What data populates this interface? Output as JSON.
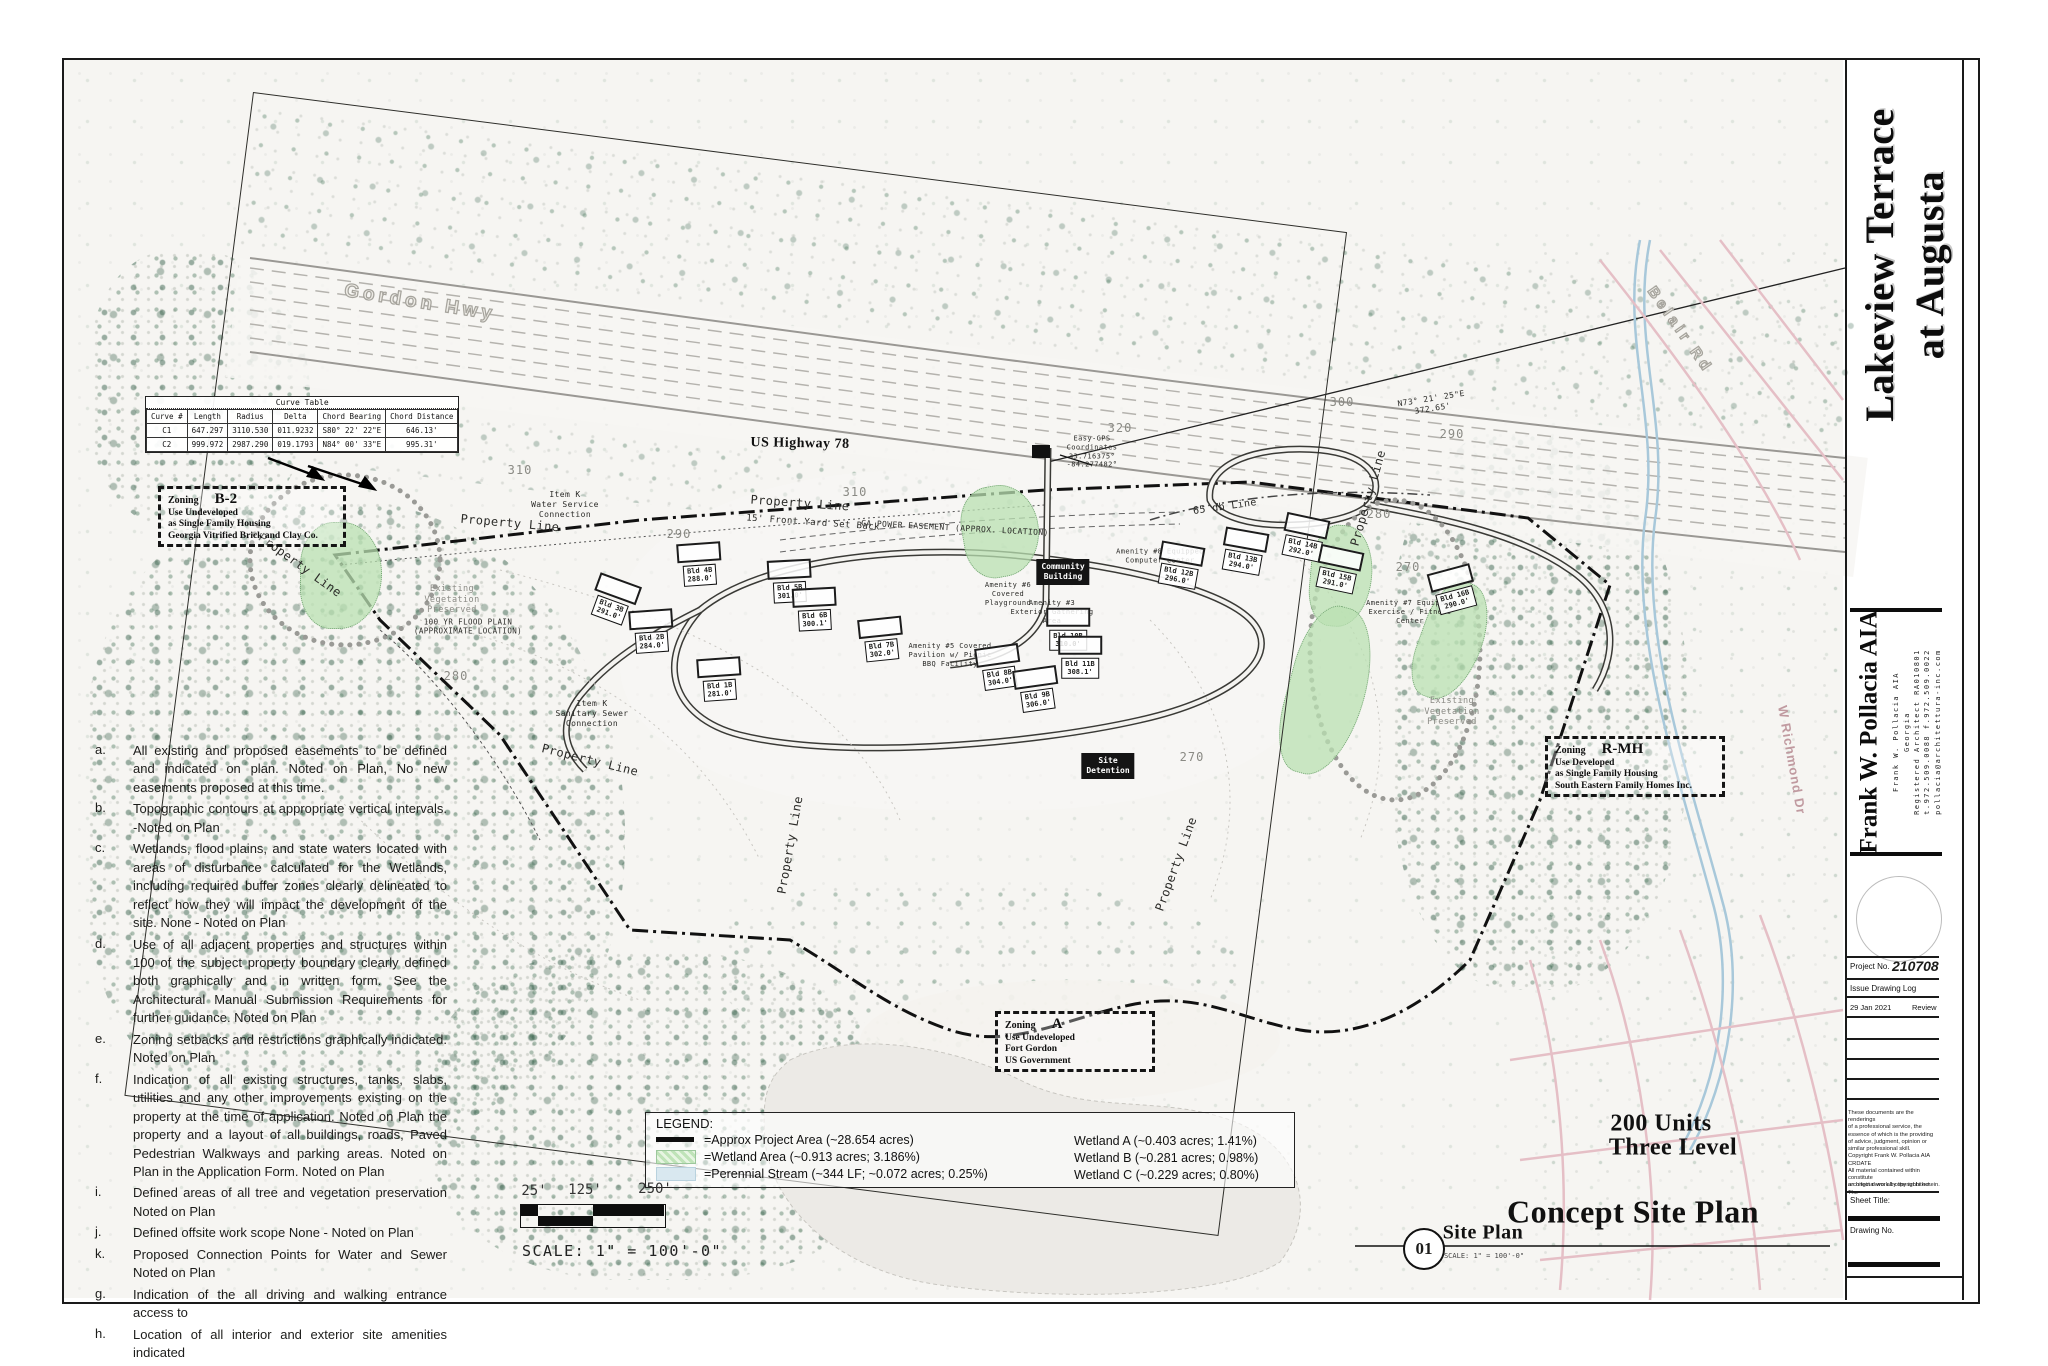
{
  "page": {
    "project_title": "Lakeview Terrace\nat Augusta",
    "drawing_title": "Concept Site Plan",
    "units_line1": "200 Units",
    "units_line2": "Three Level",
    "detail_number": "01",
    "detail_name": "Site Plan",
    "detail_scale": "SCALE: 1\" = 100'-0\"",
    "scale_text": "SCALE: 1\" = 100'-0\"",
    "scale_ticks": [
      "25'",
      "125'",
      "250'"
    ]
  },
  "architect": {
    "name_large": "Frank W. Pollacia AIA",
    "lines": [
      {
        "t": "Frank W. Pollacia AIA",
        "x": 1890
      },
      {
        "t": "Georgia",
        "x": 1901
      },
      {
        "t": "Registered Architect RA010801",
        "x": 1911
      },
      {
        "t": "t.972.509.0088 f.972.509.0022",
        "x": 1921
      },
      {
        "t": "pollacia@architettura-inc.com",
        "x": 1932
      }
    ]
  },
  "titleblock": {
    "project_no_label": "Project No.",
    "project_no": "210708",
    "issue_log_label": "Issue Drawing Log",
    "issue_date": "29 Jan 2021",
    "issue_desc": "Review",
    "disclaimer_lines": [
      {
        "t": "These documents are the renderings"
      },
      {
        "t": "of a professional service, the"
      },
      {
        "t": "essence of which is the providing"
      },
      {
        "t": "of advice, judgment, opinion or"
      },
      {
        "t": "similar professional skill."
      },
      {
        "t": "Copyright Frank W. Pollacia AIA CRDATE"
      },
      {
        "t": "All material contained within constitute"
      },
      {
        "t": "an original work by the architect. The"
      }
    ],
    "copyright_line": "architect owns all copyrights herein.",
    "sheet_title_label": "Sheet Title:",
    "drawing_no_label": "Drawing No."
  },
  "notes": [
    {
      "k": "a.",
      "t": "All existing and proposed easements to be defined and indicated on plan.  Noted on Plan, No new easements proposed at this time."
    },
    {
      "k": "b.",
      "t": "Topographic contours at appropriate vertical intervals. -Noted on Plan"
    },
    {
      "k": "c.",
      "t": "Wetlands, flood plains, and state waters located with areas of disturbance calculated for the Wetlands, including required buffer zones clearly delineated to reflect how they will impact the development of the site.  None - Noted on Plan"
    },
    {
      "k": "d.",
      "t": "Use of all adjacent properties and structures within 100 of the subject property  boundary clearly defined both graphically and in written form.  See the Architectural Manual Submission Requirements for further guidance.  Noted on Plan"
    },
    {
      "k": "e.",
      "t": "Zoning setbacks and restrictions graphically indicated. Noted on Plan"
    },
    {
      "k": "f.",
      "t": "Indication of all existing structures, tanks, slabs, utilities and any other improvements existing on the property at the time of application.  Noted on Plan the property and a layout of all buildings, roads, Paved Pedestrian Walkways and parking areas.  Noted on Plan in the Application Form.  Noted on Plan"
    },
    {
      "k": "i.",
      "t": "Defined areas of all tree and vegetation preservation Noted on Plan"
    },
    {
      "k": "j.",
      "t": "Defined offsite work scope None - Noted on Plan"
    },
    {
      "k": "k.",
      "t": "Proposed Connection Points for Water and Sewer Noted on Plan"
    },
    {
      "k": "g.",
      "t": "Indication of the all driving and walking entrance access to"
    },
    {
      "k": "h.",
      "t": "Location of all interior and exterior site amenities indicated"
    }
  ],
  "legend": {
    "title": "LEGEND:",
    "items": [
      {
        "label": "=Approx Project Area (~28.654 acres)"
      },
      {
        "label": "=Wetland Area (~0.913 acres; 3.186%)"
      },
      {
        "label": "=Perennial Stream (~344 LF; ~0.072 acres; 0.25%)"
      }
    ],
    "wetlands": [
      {
        "t": "Wetland A (~0.403 acres; 1.41%)"
      },
      {
        "t": "Wetland B (~0.281 acres; 0.98%)"
      },
      {
        "t": "Wetland C (~0.229 acres; 0.80%)"
      }
    ]
  },
  "curve_table": {
    "title": "Curve Table",
    "headers": [
      {
        "t": "Curve #"
      },
      {
        "t": "Length"
      },
      {
        "t": "Radius"
      },
      {
        "t": "Delta"
      },
      {
        "t": "Chord Bearing"
      },
      {
        "t": "Chord Distance"
      }
    ],
    "rows": [
      {
        "c0": "C1",
        "c1": "647.297",
        "c2": "3110.530",
        "c3": "011.9232",
        "c4": "S80° 22' 22\"E",
        "c5": "646.13'"
      },
      {
        "c0": "C2",
        "c1": "999.972",
        "c2": "2987.290",
        "c3": "019.1793",
        "c4": "N84° 00' 33\"E",
        "c5": "995.31'"
      }
    ]
  },
  "zoning": [
    {
      "title": "Zoning",
      "code": "B-2",
      "l1": "Use Undeveloped",
      "l2": "as Single Family Housing",
      "l3": "Georgia Vitrified Brick and Clay Co."
    },
    {
      "title": "Zoning",
      "code": "R-MH",
      "l1": "Use Developed",
      "l2": "as Single Family Housing",
      "l3": "South Eastern Family Homes Inc."
    },
    {
      "title": "Zoning",
      "code": "A",
      "l1": "Use Undeveloped",
      "l2": "Fort Gordon",
      "l3": "US Government"
    }
  ],
  "map": {
    "texts": [
      {
        "t": "Gordon Hwy",
        "x": 420,
        "y": 303,
        "rot": 9,
        "s": 19,
        "c": "outline"
      },
      {
        "t": "Belair Rd",
        "x": 1680,
        "y": 330,
        "rot": 55,
        "s": 15,
        "c": "outline"
      },
      {
        "t": "US Highway 78",
        "x": 800,
        "y": 444,
        "rot": 1,
        "s": 14,
        "c": "serifbold"
      },
      {
        "t": "W Richmond Dr",
        "x": 1792,
        "y": 760,
        "rot": 80,
        "s": 13,
        "c": "pinkroad"
      },
      {
        "t": "Property Line",
        "x": 300,
        "y": 565,
        "rot": 36,
        "s": 12
      },
      {
        "t": "Property Line",
        "x": 510,
        "y": 523,
        "rot": 5,
        "s": 12
      },
      {
        "t": "Property Line",
        "x": 800,
        "y": 503,
        "rot": 4,
        "s": 12
      },
      {
        "t": "Property Line",
        "x": 590,
        "y": 760,
        "rot": 14,
        "s": 12
      },
      {
        "t": "Property Line",
        "x": 790,
        "y": 845,
        "rot": -80,
        "s": 12
      },
      {
        "t": "Property Line",
        "x": 1176,
        "y": 864,
        "rot": -70,
        "s": 12
      },
      {
        "t": "Property Line",
        "x": 1368,
        "y": 498,
        "rot": -74,
        "s": 12
      },
      {
        "t": "15' Front Yard Set Back",
        "x": 813,
        "y": 523,
        "rot": 4,
        "s": 9
      },
      {
        "t": "GA POWER EASEMENT (APPROX. LOCATION)",
        "x": 955,
        "y": 528,
        "rot": 3,
        "s": 8
      },
      {
        "t": "65 db Line",
        "x": 1225,
        "y": 507,
        "rot": -8,
        "s": 10
      },
      {
        "t": "N73° 21' 25\"E\n372.65'",
        "x": 1432,
        "y": 404,
        "rot": -9,
        "s": 8,
        "c": "pre"
      },
      {
        "t": "Easy-GPS\nCoordinates\n33.716375°\n-84.277482°",
        "x": 1092,
        "y": 452,
        "s": 7,
        "c": "pre"
      },
      {
        "t": "Item K\nWater Service\nConnection",
        "x": 565,
        "y": 505,
        "s": 8,
        "c": "pre"
      },
      {
        "t": "Item K\nSanitary Sewer\nConnection",
        "x": 592,
        "y": 714,
        "s": 8,
        "c": "pre"
      },
      {
        "t": "100 YR FLOOD PLAIN\n(APPROXIMATE LOCATION)",
        "x": 468,
        "y": 627,
        "s": 7.5,
        "c": "pre"
      },
      {
        "t": "Existing\nVegetation\nPreserved",
        "x": 452,
        "y": 600,
        "s": 8.5,
        "c": "veg"
      },
      {
        "t": "Existing\nVegetation\nPreserved",
        "x": 1452,
        "y": 712,
        "s": 8.5,
        "c": "veg"
      },
      {
        "t": "310",
        "x": 855,
        "y": 492,
        "s": 12,
        "c": "contour"
      },
      {
        "t": "310",
        "x": 520,
        "y": 470,
        "s": 12,
        "c": "contour"
      },
      {
        "t": "300",
        "x": 1342,
        "y": 402,
        "s": 12,
        "c": "contour"
      },
      {
        "t": "290",
        "x": 1452,
        "y": 434,
        "s": 12,
        "c": "contour"
      },
      {
        "t": "320",
        "x": 1120,
        "y": 428,
        "s": 12,
        "c": "contour"
      },
      {
        "t": "290",
        "x": 679,
        "y": 534,
        "s": 12,
        "c": "contour"
      },
      {
        "t": "280",
        "x": 1379,
        "y": 514,
        "s": 12,
        "c": "contour"
      },
      {
        "t": "270",
        "x": 1408,
        "y": 567,
        "s": 12,
        "c": "contour"
      },
      {
        "t": "280",
        "x": 456,
        "y": 676,
        "s": 12,
        "c": "contour"
      },
      {
        "t": "270",
        "x": 1192,
        "y": 757,
        "s": 12,
        "c": "contour"
      },
      {
        "t": "Amenity #6\nCovered\nPlayground",
        "x": 1008,
        "y": 594,
        "s": 7,
        "c": "pre"
      },
      {
        "t": "Amenity #5 Covered\nPavilion w/ Picnic\nBBQ Facility",
        "x": 950,
        "y": 655,
        "s": 7,
        "c": "pre"
      },
      {
        "t": "Amenity #3\nExterior Gathering\nArea",
        "x": 1052,
        "y": 612,
        "s": 7,
        "c": "pre"
      },
      {
        "t": "Amenity #8 Equipped\nComputer Center",
        "x": 1160,
        "y": 556,
        "s": 7,
        "c": "pre"
      },
      {
        "t": "Amenity #7 Equipped\nExercise / Fitness\nCenter",
        "x": 1410,
        "y": 612,
        "s": 7,
        "c": "pre"
      }
    ],
    "buildings": [
      {
        "n": "Bld 1B",
        "e": "281.0'",
        "x": 720,
        "y": 690,
        "rot": -4
      },
      {
        "n": "Bld 2B",
        "e": "284.0'",
        "x": 652,
        "y": 642,
        "rot": -4
      },
      {
        "n": "Bld 3B",
        "e": "291.0'",
        "x": 610,
        "y": 610,
        "rot": 20
      },
      {
        "n": "Bld 4B",
        "e": "288.0'",
        "x": 700,
        "y": 575,
        "rot": -4
      },
      {
        "n": "Bld 5B",
        "e": "301.0'",
        "x": 790,
        "y": 592,
        "rot": -3
      },
      {
        "n": "Bld 6B",
        "e": "300.1'",
        "x": 815,
        "y": 620,
        "rot": -3
      },
      {
        "n": "Bld 7B",
        "e": "302.0'",
        "x": 882,
        "y": 650,
        "rot": -6
      },
      {
        "n": "Bld 8B",
        "e": "304.0'",
        "x": 1000,
        "y": 678,
        "rot": -8
      },
      {
        "n": "Bld 9B",
        "e": "306.0'",
        "x": 1038,
        "y": 700,
        "rot": -8
      },
      {
        "n": "Bld 10B",
        "e": "310.0'",
        "x": 1068,
        "y": 640,
        "rot": 0
      },
      {
        "n": "Bld 11B",
        "e": "308.1'",
        "x": 1080,
        "y": 668,
        "rot": 0
      },
      {
        "n": "Bld 12B",
        "e": "296.0'",
        "x": 1178,
        "y": 576,
        "rot": 10
      },
      {
        "n": "Bld 13B",
        "e": "294.0'",
        "x": 1242,
        "y": 562,
        "rot": 10
      },
      {
        "n": "Bld 14B",
        "e": "292.0'",
        "x": 1302,
        "y": 548,
        "rot": 12
      },
      {
        "n": "Bld 15B",
        "e": "291.0'",
        "x": 1336,
        "y": 580,
        "rot": 12
      },
      {
        "n": "Bld 16B",
        "e": "290.0'",
        "x": 1456,
        "y": 600,
        "rot": -15
      }
    ],
    "black_boxes": [
      {
        "l1": "Community",
        "l2": "Building",
        "x": 1063,
        "y": 572
      },
      {
        "l1": "Site",
        "l2": "Detention",
        "x": 1108,
        "y": 766
      }
    ]
  }
}
